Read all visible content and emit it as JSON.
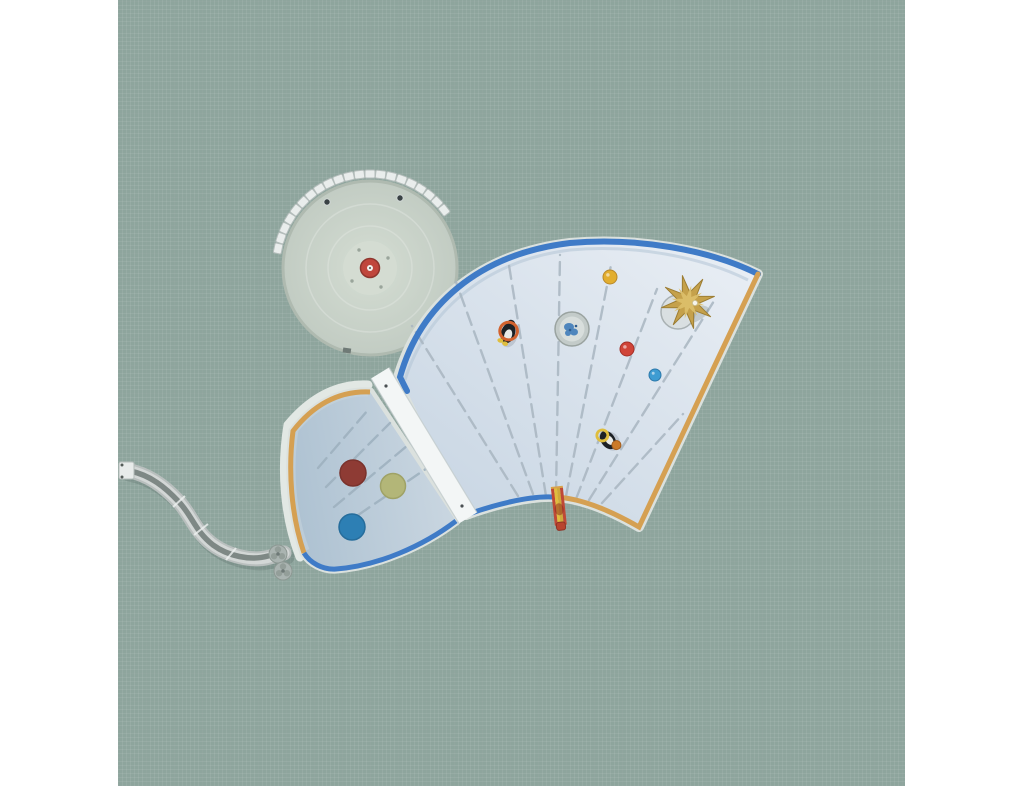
{
  "scene": {
    "label": "aerial-top-down-water-playground-photo",
    "background_color": "#8ea59d",
    "margin_color": "#ffffff"
  },
  "colors": {
    "pool_light": "#eaeff5",
    "pool_mid": "#c6d4e2",
    "pool_small_light": "#ccd8e2",
    "pool_small_dark": "#aec2d2",
    "border_blue": "#3f7bc7",
    "border_orange": "#d5a052",
    "coping_pale": "#dbe1de",
    "bridge_white": "#f3f6f6",
    "bridge_edge": "#c3cccd",
    "walkway_white": "#e2e8e4",
    "lane_line": "#a9b6c1",
    "lane_line_small": "#9db0be",
    "ledge_small": "#c9d5dd",
    "inner_band": "#b3c4d6",
    "carousel_fill_center": "#cfd8ce",
    "carousel_fill_edge": "#c2ccc3",
    "carousel_rim": "#afbab0",
    "carousel_mound": "#d4ddd3",
    "carousel_center_red": "#c0463c",
    "carousel_center_red_dark": "#8f362e",
    "carousel_center_dot": "#f2f2ef",
    "seat_fill": "#e9edec",
    "seat_stroke": "#b4bdbb",
    "speaker_dark": "#3a4245",
    "slide_outer": "#b9bfbe",
    "slide_body": "#d3d7d6",
    "slide_channel": "#7e8885",
    "slide_shadow": "rgba(70,85,80,0.22)",
    "clover_grey": "#aab4b1",
    "clover_dark": "#8d9893",
    "palm_gold": "#c5a14b",
    "palm_gold_dark": "#9c7d33",
    "palm_gold_light": "#ddc06c",
    "palm_base": "#d9dfe1",
    "palm_base_rim": "#a9b1b3",
    "fountain_ring": "#c3cbc9",
    "fountain_ring_stroke": "#9aa3a0",
    "fountain_inner": "#d8dedc",
    "fountain_splash": "#4f86bd",
    "penguin_black": "#1d2125",
    "penguin_white": "#e9eae7",
    "penguin_orange": "#d2622e",
    "penguin_yellow": "#dfbe3e",
    "mini_slide_red": "#bf4936",
    "mini_slide_yellow": "#e0bd3e",
    "mini_slide_orange": "#cfa93a",
    "mini_slide_tip": "#b8442f"
  },
  "carousel": {
    "cx": 252,
    "cy": 268,
    "r": 87,
    "seats": {
      "count": 21,
      "angle_start_deg": 38,
      "angle_end_deg": 168,
      "radius": 94,
      "w": 10,
      "h": 8
    },
    "speakers": [
      {
        "x": 209,
        "y": 202
      },
      {
        "x": 282,
        "y": 198
      }
    ],
    "center": {
      "x": 252,
      "y": 268,
      "r": 9.5,
      "dot_r": 3
    },
    "mound_r": 27
  },
  "balls": [
    {
      "name": "yellow-ball",
      "x": 492,
      "y": 277,
      "r": 7,
      "fill": "#e2ae2f",
      "stroke": "#b8882a"
    },
    {
      "name": "red-ball",
      "x": 509,
      "y": 349,
      "r": 7,
      "fill": "#d04438",
      "stroke": "#a33028"
    },
    {
      "name": "blue-ball",
      "x": 537,
      "y": 375,
      "r": 6,
      "fill": "#3e9cd2",
      "stroke": "#2d79ab"
    }
  ],
  "play_discs": [
    {
      "name": "maroon-disc",
      "x": 235,
      "y": 473,
      "r": 13,
      "fill": "#8e3b34",
      "stroke": "#7a322c"
    },
    {
      "name": "olive-disc",
      "x": 275,
      "y": 486,
      "r": 12.5,
      "fill": "#b3b678",
      "stroke": "#9fa266"
    },
    {
      "name": "blue-disc",
      "x": 234,
      "y": 527,
      "r": 13,
      "fill": "#2d7fb4",
      "stroke": "#266d9c"
    }
  ],
  "lane_lines": {
    "big": [
      [
        400,
        496,
        294,
        326
      ],
      [
        415,
        494,
        338,
        282
      ],
      [
        428,
        496,
        390,
        259
      ],
      [
        438,
        495,
        442,
        255
      ],
      [
        448,
        496,
        493,
        265
      ],
      [
        458,
        499,
        539,
        289
      ],
      [
        471,
        500,
        596,
        301
      ],
      [
        484,
        503,
        565,
        414
      ]
    ],
    "small": [
      [
        200,
        468,
        250,
        410
      ],
      [
        208,
        487,
        272,
        423
      ],
      [
        216,
        507,
        296,
        440
      ],
      [
        224,
        526,
        318,
        462
      ]
    ]
  },
  "palm": {
    "cx": 570,
    "cy": 302,
    "points": 8,
    "r_outer": 27,
    "r_inner": 10,
    "rotation_deg": 12,
    "base_cx": 560,
    "base_cy": 312,
    "base_r": 17,
    "dot_x": 577,
    "dot_y": 303
  }
}
